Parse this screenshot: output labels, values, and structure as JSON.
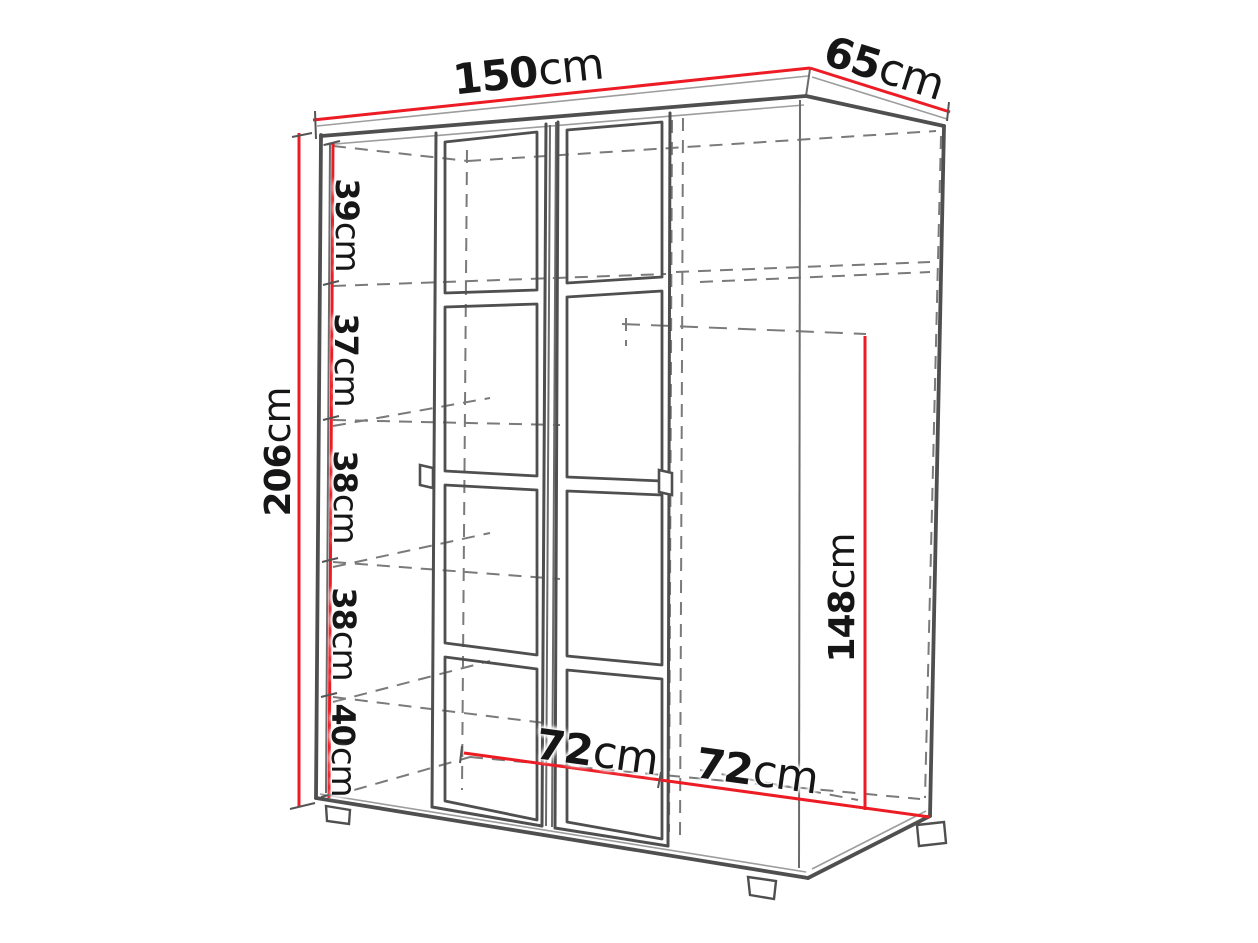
{
  "diagram": {
    "kind": "wardrobe-dimension-drawing",
    "unit": "cm"
  },
  "dimensions": {
    "width": {
      "value": "150",
      "unit": "cm"
    },
    "depth": {
      "value": "65",
      "unit": "cm"
    },
    "height": {
      "value": "206",
      "unit": "cm"
    },
    "shelf_spacing_1": {
      "value": "39",
      "unit": "cm"
    },
    "shelf_spacing_2": {
      "value": "37",
      "unit": "cm"
    },
    "shelf_spacing_3": {
      "value": "38",
      "unit": "cm"
    },
    "shelf_spacing_4": {
      "value": "38",
      "unit": "cm"
    },
    "shelf_spacing_5": {
      "value": "40",
      "unit": "cm"
    },
    "interior_left_width": {
      "value": "72",
      "unit": "cm"
    },
    "interior_right_width": {
      "value": "72",
      "unit": "cm"
    },
    "hanging_space_height": {
      "value": "148",
      "unit": "cm"
    }
  },
  "colors": {
    "dimension_line_red": "#ed1c24",
    "outline_dark": "#4f4f4f",
    "outline_light": "#9d9d9d",
    "hidden_line": "#7a7a7a",
    "text": "#161616",
    "background": "#ffffff"
  }
}
